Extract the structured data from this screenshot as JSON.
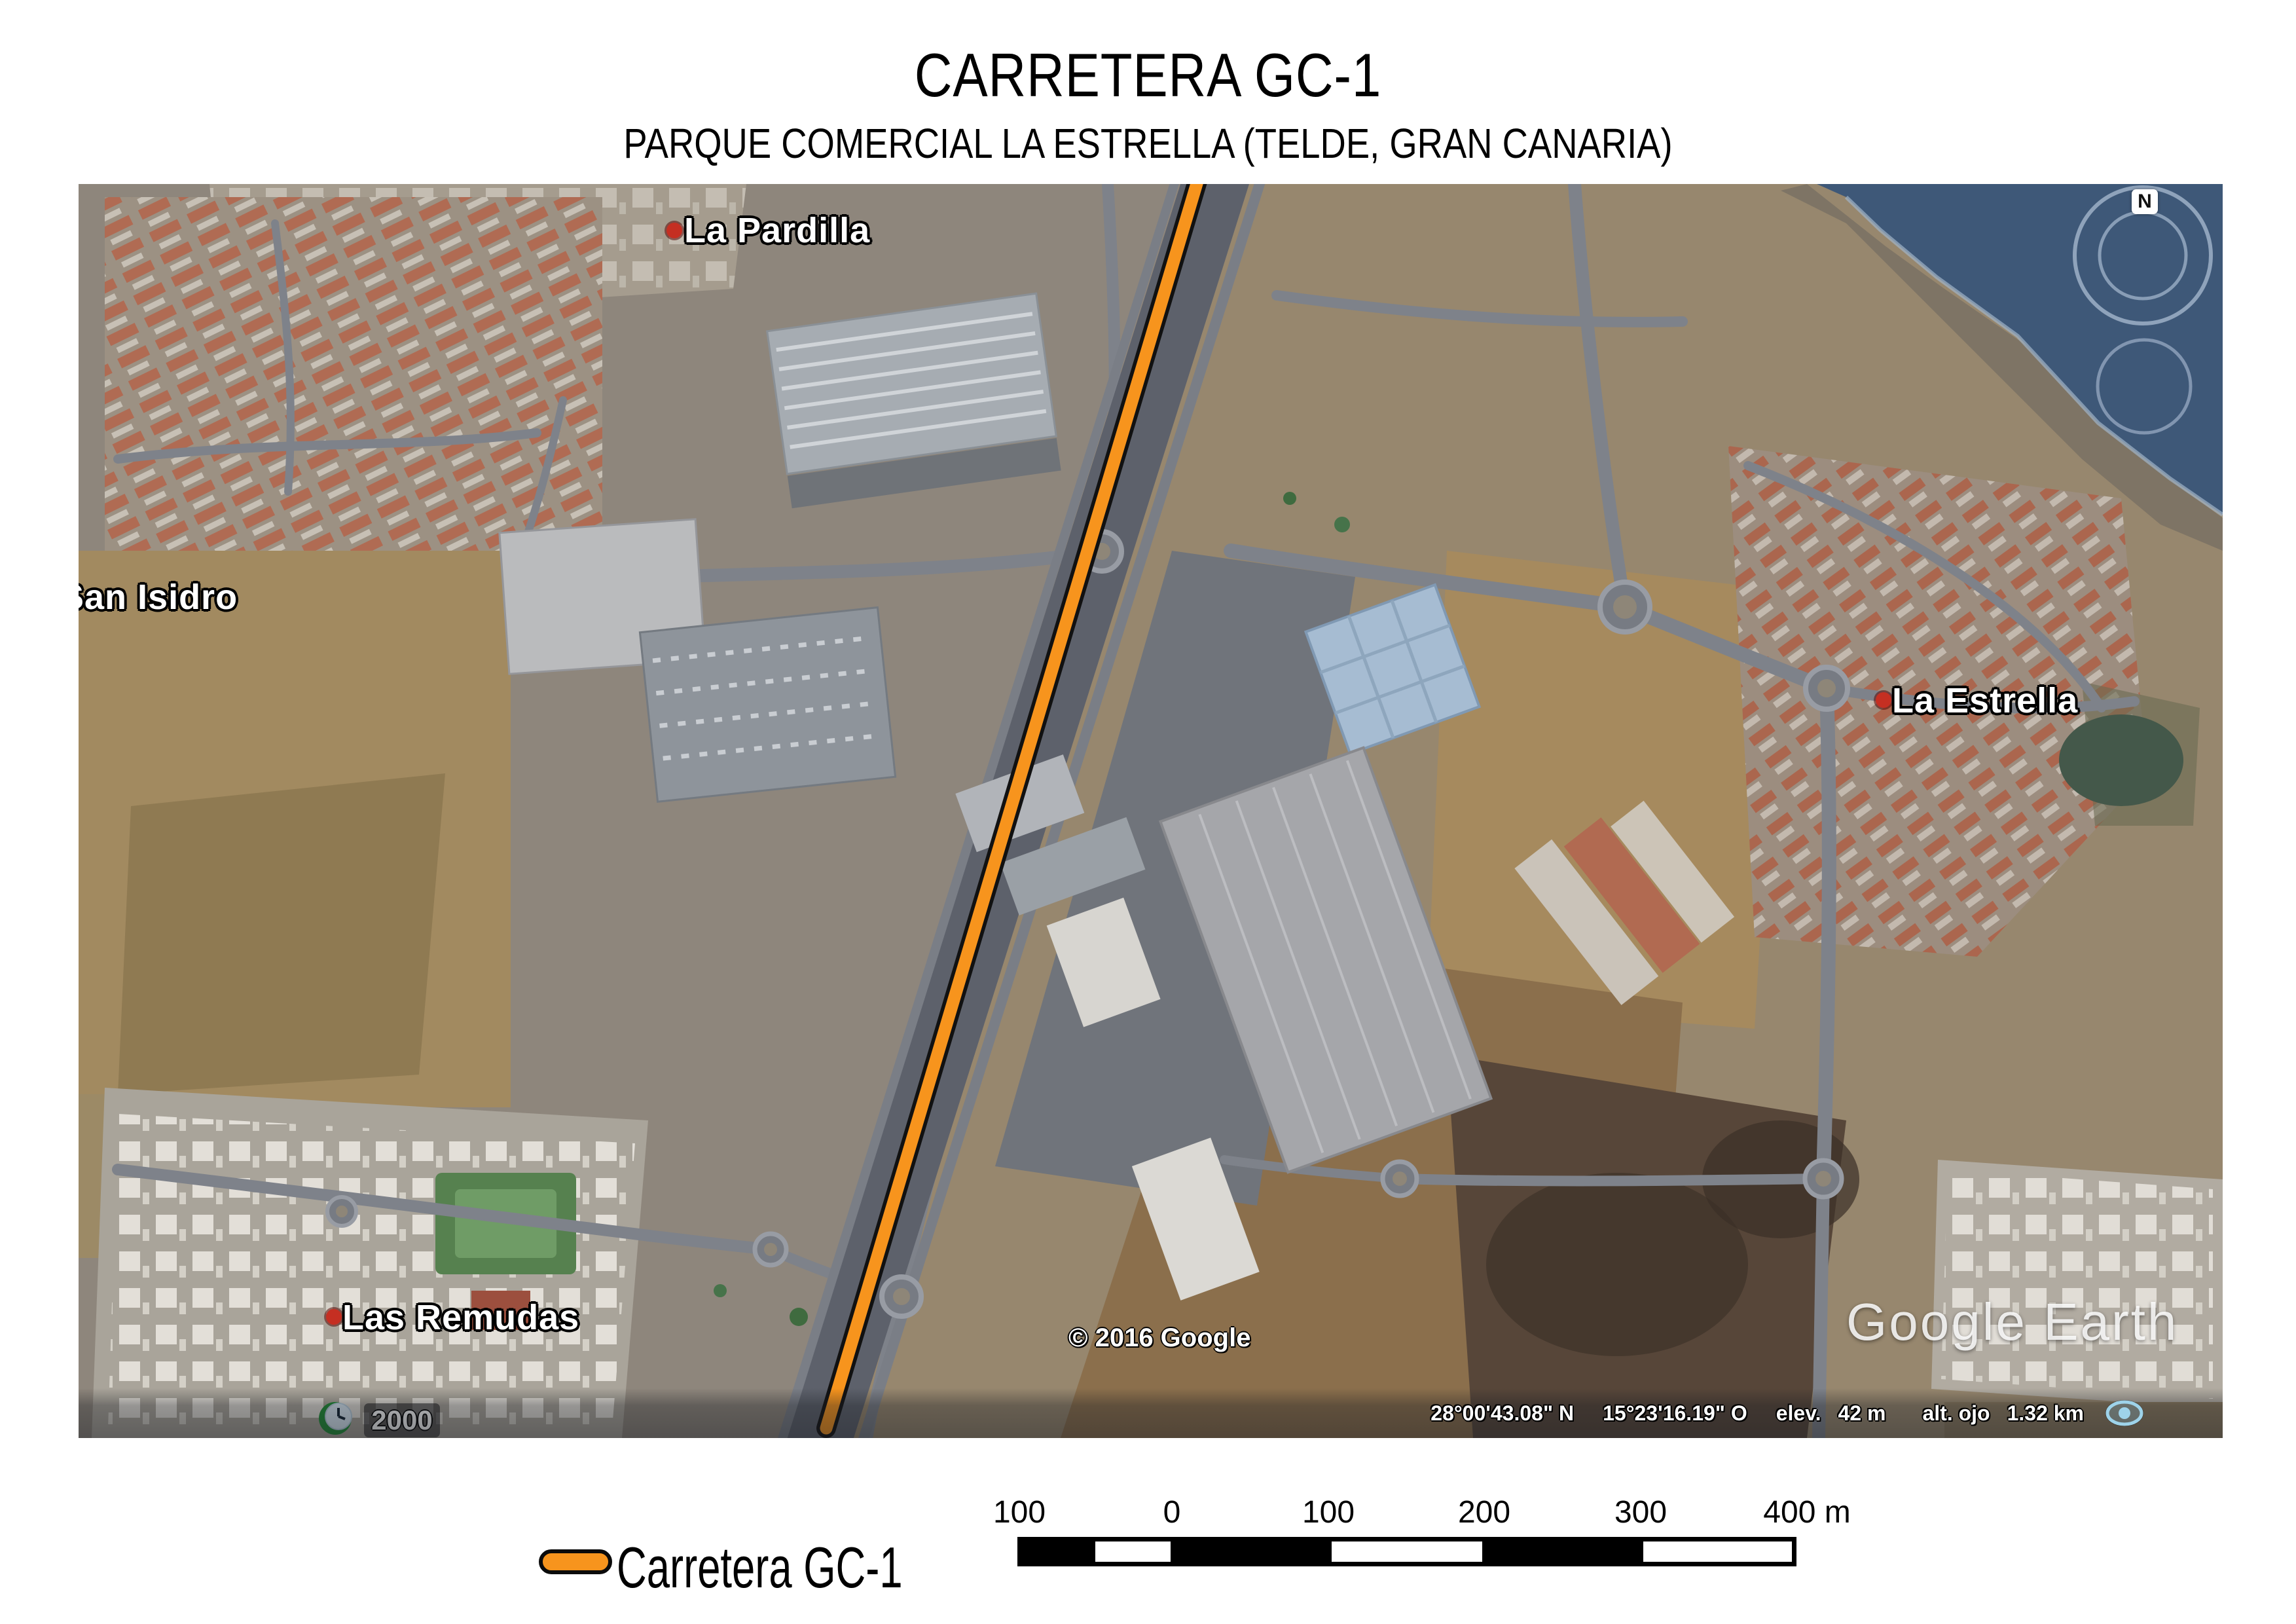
{
  "page": {
    "title": "CARRETERA GC-1",
    "subtitle": "PARQUE COMERCIAL LA ESTRELLA (TELDE, GRAN CANARIA)"
  },
  "map": {
    "place_labels": [
      {
        "name": "La Pardilla"
      },
      {
        "name": "San Isidro"
      },
      {
        "name": "La Estrella"
      },
      {
        "name": "Las Remudas"
      }
    ],
    "compass": {
      "north_label": "N"
    },
    "time_badge": {
      "year": "2000"
    },
    "copyright": "© 2016 Google",
    "watermark": "Google Earth",
    "status_bar": {
      "latitude": "28°00'43.08\" N",
      "longitude": "15°23'16.19\" O",
      "elevation_label": "elev.",
      "elevation_value": "42 m",
      "eye_altitude_label": "alt. ojo",
      "eye_altitude_value": "1.32 km"
    }
  },
  "legend": {
    "swatch_color": "#F7941D",
    "label": "Carretera GC-1"
  },
  "scale_bar": {
    "unit": "m",
    "ticks": [
      "100",
      "0",
      "100",
      "200",
      "300",
      "400 m"
    ]
  },
  "colors": {
    "route_orange": "#F7941D",
    "route_outline": "#111111",
    "sea_blue": "#3E5878",
    "status_text": "#FFFFFF"
  }
}
